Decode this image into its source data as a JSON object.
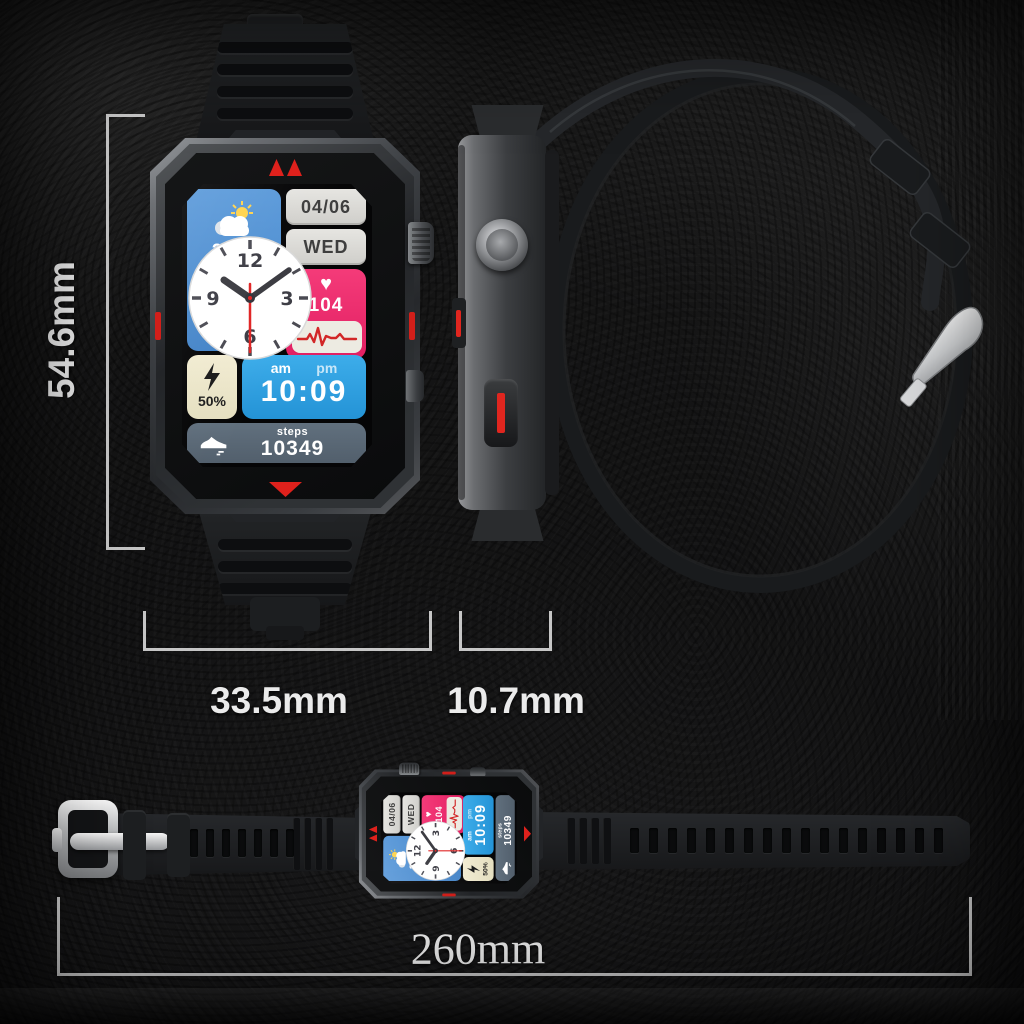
{
  "dimensions": {
    "height": "54.6mm",
    "case_width": "33.5mm",
    "thickness": "10.7mm",
    "band_length": "260mm"
  },
  "watch_face": {
    "weather": {
      "temperature": "24°C",
      "icon": "sun-cloud"
    },
    "date": "04/06",
    "day": "WED",
    "heart_rate": {
      "icon": "heart",
      "value": "104",
      "ecg_icon": "heartbeat-wave"
    },
    "clock": {
      "n12": "12",
      "n3": "3",
      "n6": "6",
      "n9": "9"
    },
    "battery": {
      "icon": "lightning-bolt",
      "level": "50%"
    },
    "time": {
      "am": "am",
      "pm": "pm",
      "value": "10:09"
    },
    "steps": {
      "icon": "running-shoe",
      "label": "steps",
      "value": "10349"
    }
  },
  "colors": {
    "weather_tile": "#4A8FD2",
    "info_pill": "#DCDAD5",
    "info_pill_text": "#3E3E3E",
    "heart_tile": "#EE2E6D",
    "ecg_inset": "#EDEBE2",
    "time_tile": "#2FA2E4",
    "battery_tile": "#EFE9CD",
    "steps_tile": "#5D6C7B",
    "accent_red": "#DF211C",
    "bracket": "#D6D6D6",
    "background": "#141414"
  },
  "icons": {
    "weather": "sun-cloud",
    "heart": "heart",
    "ecg": "heartbeat-wave",
    "battery": "lightning-bolt",
    "steps": "running-shoe",
    "buckle": "silver-buckle"
  }
}
